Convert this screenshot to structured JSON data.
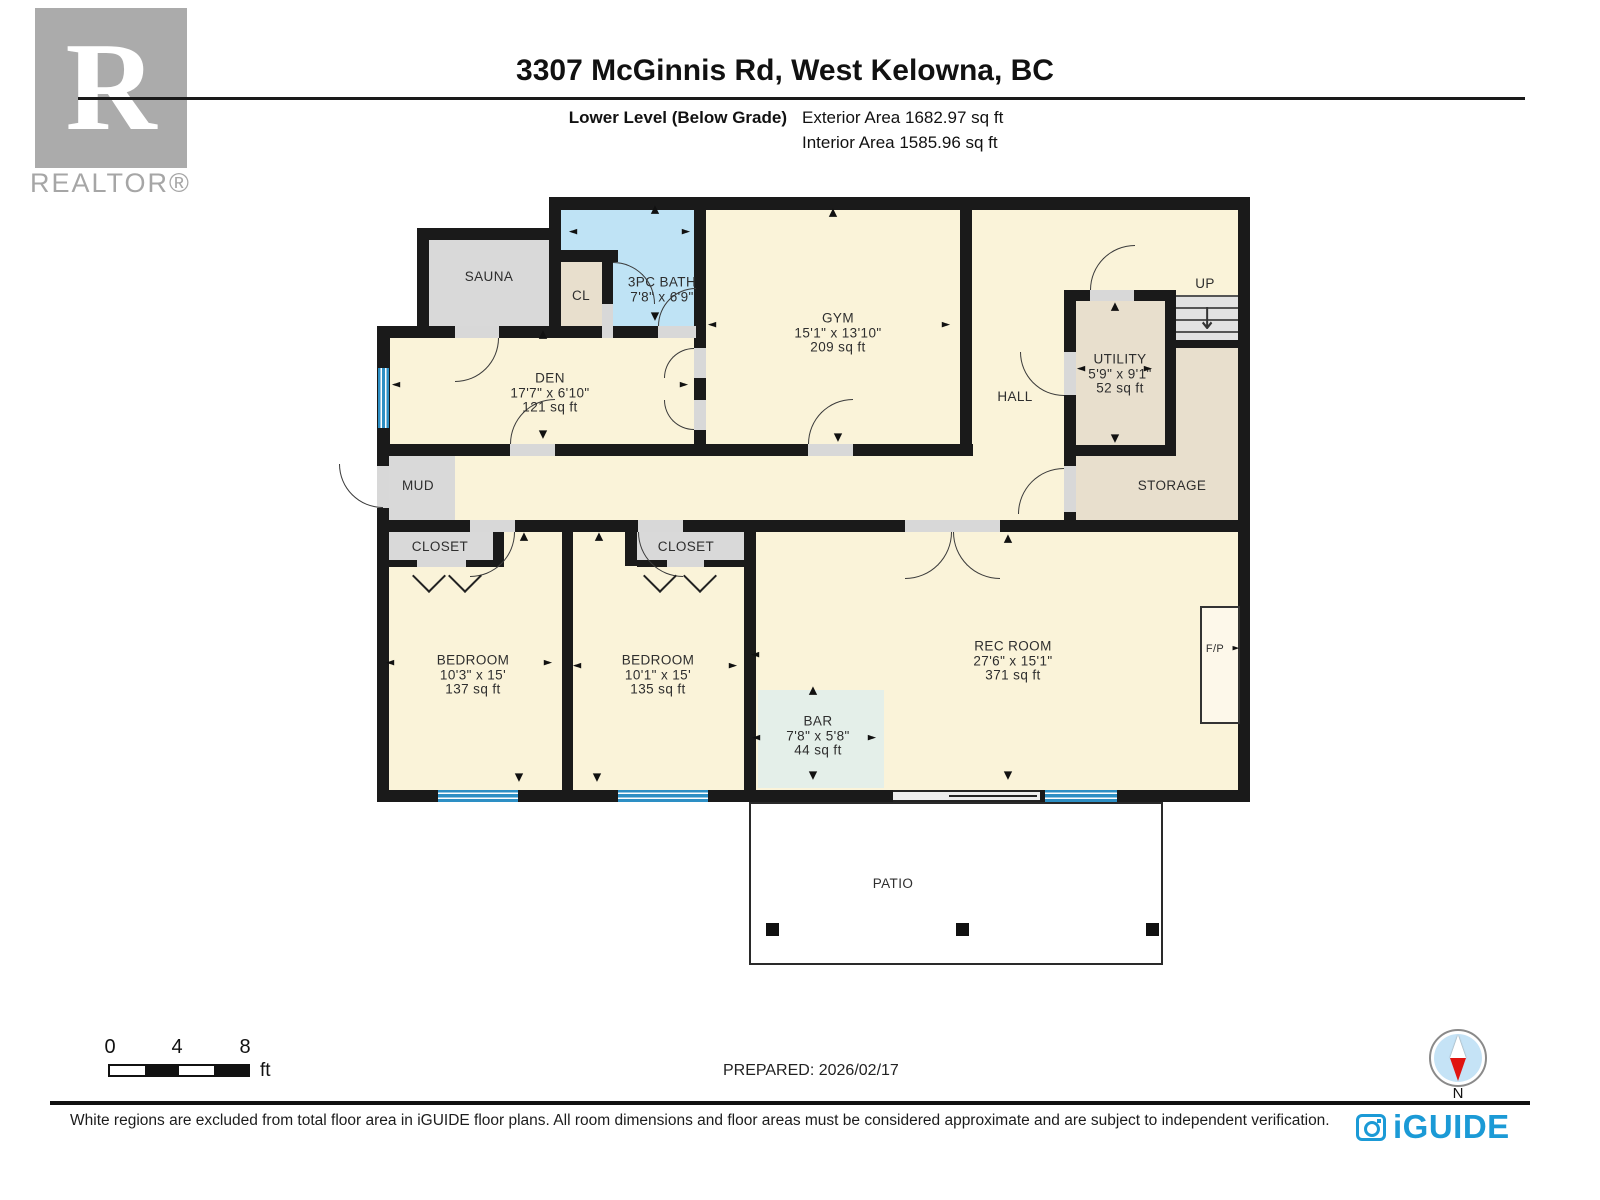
{
  "header": {
    "title": "3307 McGinnis Rd, West Kelowna, BC",
    "level": "Lower Level (Below Grade)",
    "exterior_area": "Exterior Area 1682.97 sq ft",
    "interior_area": "Interior Area 1585.96 sq ft"
  },
  "branding": {
    "realtor_letter": "R",
    "realtor_text": "REALTOR®",
    "iguide_text": "iGUIDE"
  },
  "rooms": {
    "sauna": {
      "name": "SAUNA"
    },
    "cl": {
      "name": "CL"
    },
    "bath": {
      "name": "3PC BATH",
      "dims": "7'8\" x 6'9\""
    },
    "gym": {
      "name": "GYM",
      "dims": "15'1\" x 13'10\"",
      "area": "209 sq ft"
    },
    "den": {
      "name": "DEN",
      "dims": "17'7\" x 6'10\"",
      "area": "121 sq ft"
    },
    "hall": {
      "name": "HALL"
    },
    "up": {
      "name": "UP"
    },
    "utility": {
      "name": "UTILITY",
      "dims": "5'9\" x 9'1\"",
      "area": "52 sq ft"
    },
    "storage": {
      "name": "STORAGE"
    },
    "mud": {
      "name": "MUD"
    },
    "closet1": {
      "name": "CLOSET"
    },
    "closet2": {
      "name": "CLOSET"
    },
    "bedroom1": {
      "name": "BEDROOM",
      "dims": "10'3\" x 15'",
      "area": "137 sq ft"
    },
    "bedroom2": {
      "name": "BEDROOM",
      "dims": "10'1\" x 15'",
      "area": "135 sq ft"
    },
    "recroom": {
      "name": "REC ROOM",
      "dims": "27'6\" x 15'1\"",
      "area": "371 sq ft"
    },
    "bar": {
      "name": "BAR",
      "dims": "7'8\" x 5'8\"",
      "area": "44 sq ft"
    },
    "fireplace": {
      "name": "F/P"
    },
    "patio": {
      "name": "PATIO"
    }
  },
  "scale_bar": {
    "t0": "0",
    "t4": "4",
    "t8": "8",
    "unit": "ft"
  },
  "footer": {
    "prepared": "PREPARED: 2026/02/17",
    "compass_label": "N",
    "disclaimer": "White regions are excluded from total floor area in iGUIDE floor plans. All room dimensions and floor areas must be considered approximate and are subject to independent verification."
  },
  "icons": {
    "dimension_arrow": "▲▼◄►",
    "stairs_down_arrow": "↓"
  },
  "colors": {
    "room_fill": "#faf3d9",
    "tan_fill": "#e8dfcd",
    "gray_fill": "#d9d9d9",
    "bath_fill": "#bfe3f5",
    "bar_fill": "#e4efe9",
    "window_blue": "#2d8fc4",
    "wall": "#1a1a1a",
    "iguide_blue": "#1b9ad6",
    "compass_red": "#e01410",
    "realtor_gray": "#ababab"
  }
}
